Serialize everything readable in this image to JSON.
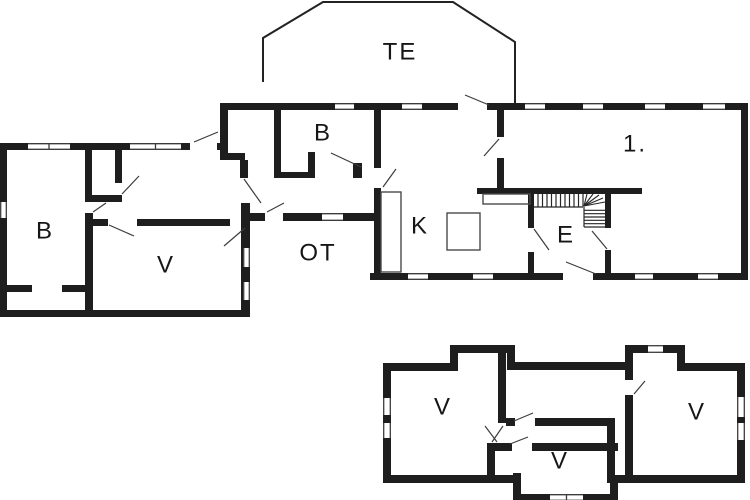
{
  "plan": {
    "width": 750,
    "height": 500,
    "background": "#ffffff",
    "wall_color": "#1e1e1e",
    "thin_line_color": "#3c3c3c",
    "label_color": "#161616",
    "label_font_size": 24,
    "labels": [
      {
        "text": "TE",
        "x": 400,
        "y": 52
      },
      {
        "text": "B",
        "x": 45,
        "y": 231
      },
      {
        "text": "V",
        "x": 166,
        "y": 265
      },
      {
        "text": "B",
        "x": 323,
        "y": 133
      },
      {
        "text": "OT",
        "x": 318,
        "y": 253
      },
      {
        "text": "K",
        "x": 420,
        "y": 226
      },
      {
        "text": "E",
        "x": 566,
        "y": 235
      },
      {
        "text": "1.",
        "x": 635,
        "y": 144
      },
      {
        "text": "V",
        "x": 443,
        "y": 407
      },
      {
        "text": "V",
        "x": 560,
        "y": 461
      },
      {
        "text": "V",
        "x": 697,
        "y": 412
      }
    ],
    "walls": [
      [
        0,
        143,
        228,
        7
      ],
      [
        220,
        103,
        8,
        57
      ],
      [
        227,
        153,
        18,
        7
      ],
      [
        240,
        160,
        8,
        18
      ],
      [
        241,
        203,
        9,
        107
      ],
      [
        250,
        213,
        8,
        8
      ],
      [
        0,
        143,
        7,
        174
      ],
      [
        0,
        310,
        250,
        7
      ],
      [
        85,
        148,
        7,
        54
      ],
      [
        85,
        195,
        37,
        7
      ],
      [
        115,
        148,
        7,
        35
      ],
      [
        85,
        213,
        8,
        97
      ],
      [
        93,
        219,
        137,
        7
      ],
      [
        7,
        285,
        25,
        7
      ],
      [
        62,
        285,
        23,
        7
      ],
      [
        220,
        103,
        528,
        7
      ],
      [
        741,
        103,
        7,
        177
      ],
      [
        370,
        273,
        378,
        7
      ],
      [
        374,
        109,
        7,
        171
      ],
      [
        274,
        109,
        7,
        69
      ],
      [
        274,
        172,
        41,
        6
      ],
      [
        308,
        152,
        7,
        26
      ],
      [
        353,
        163,
        9,
        15
      ],
      [
        497,
        109,
        7,
        81
      ],
      [
        477,
        188,
        165,
        6
      ],
      [
        528,
        194,
        6,
        79
      ],
      [
        605,
        192,
        6,
        81
      ],
      [
        252,
        213,
        122,
        8
      ],
      [
        383,
        363,
        8,
        120
      ],
      [
        383,
        363,
        75,
        8
      ],
      [
        450,
        345,
        8,
        26
      ],
      [
        450,
        345,
        65,
        8
      ],
      [
        507,
        345,
        8,
        25
      ],
      [
        507,
        362,
        118,
        8
      ],
      [
        625,
        345,
        8,
        138
      ],
      [
        625,
        345,
        60,
        8
      ],
      [
        677,
        345,
        8,
        26
      ],
      [
        677,
        363,
        68,
        8
      ],
      [
        737,
        363,
        8,
        120
      ],
      [
        610,
        475,
        135,
        8
      ],
      [
        610,
        475,
        8,
        26
      ],
      [
        513,
        494,
        105,
        7
      ],
      [
        513,
        473,
        8,
        28
      ],
      [
        383,
        475,
        138,
        8
      ],
      [
        498,
        353,
        8,
        97
      ],
      [
        506,
        418,
        109,
        8
      ],
      [
        487,
        443,
        131,
        8
      ],
      [
        487,
        443,
        8,
        40
      ],
      [
        607,
        426,
        8,
        57
      ]
    ],
    "door_openings": [
      [
        190,
        143,
        27,
        7
      ],
      [
        240,
        178,
        8,
        25
      ],
      [
        115,
        183,
        7,
        12
      ],
      [
        108,
        219,
        29,
        7
      ],
      [
        265,
        213,
        18,
        8
      ],
      [
        374,
        168,
        7,
        20
      ],
      [
        497,
        137,
        7,
        21
      ],
      [
        528,
        228,
        6,
        24
      ],
      [
        605,
        228,
        6,
        22
      ],
      [
        563,
        273,
        30,
        7
      ],
      [
        458,
        103,
        29,
        7
      ],
      [
        498,
        423,
        8,
        20
      ],
      [
        515,
        418,
        20,
        8
      ],
      [
        512,
        443,
        20,
        8
      ],
      [
        625,
        380,
        8,
        15
      ]
    ],
    "windows": [
      [
        28,
        143,
        42,
        7
      ],
      [
        130,
        143,
        51,
        7
      ],
      [
        0,
        202,
        7,
        16
      ],
      [
        243,
        248,
        7,
        19
      ],
      [
        243,
        282,
        7,
        18
      ],
      [
        335,
        103,
        19,
        7
      ],
      [
        402,
        103,
        20,
        7
      ],
      [
        525,
        103,
        20,
        7
      ],
      [
        583,
        103,
        20,
        7
      ],
      [
        645,
        103,
        20,
        7
      ],
      [
        703,
        103,
        22,
        7
      ],
      [
        322,
        213,
        21,
        8
      ],
      [
        408,
        273,
        20,
        7
      ],
      [
        473,
        273,
        20,
        7
      ],
      [
        635,
        273,
        18,
        7
      ],
      [
        698,
        273,
        20,
        7
      ],
      [
        383,
        398,
        8,
        17
      ],
      [
        383,
        423,
        8,
        15
      ],
      [
        737,
        397,
        8,
        20
      ],
      [
        737,
        423,
        8,
        17
      ],
      [
        648,
        345,
        15,
        8
      ],
      [
        550,
        494,
        33,
        7
      ]
    ],
    "door_swings": [
      [
        194,
        142,
        218,
        132
      ],
      [
        122,
        194,
        139,
        176
      ],
      [
        93,
        212,
        106,
        203
      ],
      [
        109,
        225,
        134,
        236
      ],
      [
        245,
        228,
        224,
        246
      ],
      [
        244,
        179,
        261,
        203
      ],
      [
        267,
        212,
        284,
        203
      ],
      [
        383,
        187,
        396,
        169
      ],
      [
        331,
        153,
        361,
        167
      ],
      [
        465,
        95,
        489,
        105
      ],
      [
        499,
        139,
        484,
        156
      ],
      [
        534,
        229,
        549,
        250
      ],
      [
        607,
        249,
        592,
        231
      ],
      [
        566,
        262,
        596,
        274
      ],
      [
        497,
        442,
        485,
        426
      ],
      [
        503,
        426,
        492,
        442
      ],
      [
        514,
        421,
        533,
        413
      ],
      [
        510,
        444,
        528,
        437
      ],
      [
        634,
        394,
        645,
        381
      ]
    ],
    "furniture_outlines": [
      [
        381,
        192,
        20,
        80
      ],
      [
        483,
        194,
        47,
        10
      ],
      [
        447,
        213,
        33,
        37
      ]
    ],
    "terrace_outline": "263,82 263,38 323,2 453,2 515,42 515,103",
    "stairs": {
      "horizontal_flight": {
        "x0": 534,
        "x1": 583,
        "y0": 194,
        "y1": 207,
        "steps": 10
      },
      "fan_center": [
        584,
        206
      ],
      "fan_tips": [
        [
          587,
          194
        ],
        [
          593,
          194
        ],
        [
          599,
          195
        ],
        [
          603,
          198
        ],
        [
          605,
          202
        ]
      ],
      "vertical_flight": {
        "x0": 584,
        "x1": 605,
        "y0": 207,
        "y1": 227,
        "steps": 6
      }
    }
  }
}
